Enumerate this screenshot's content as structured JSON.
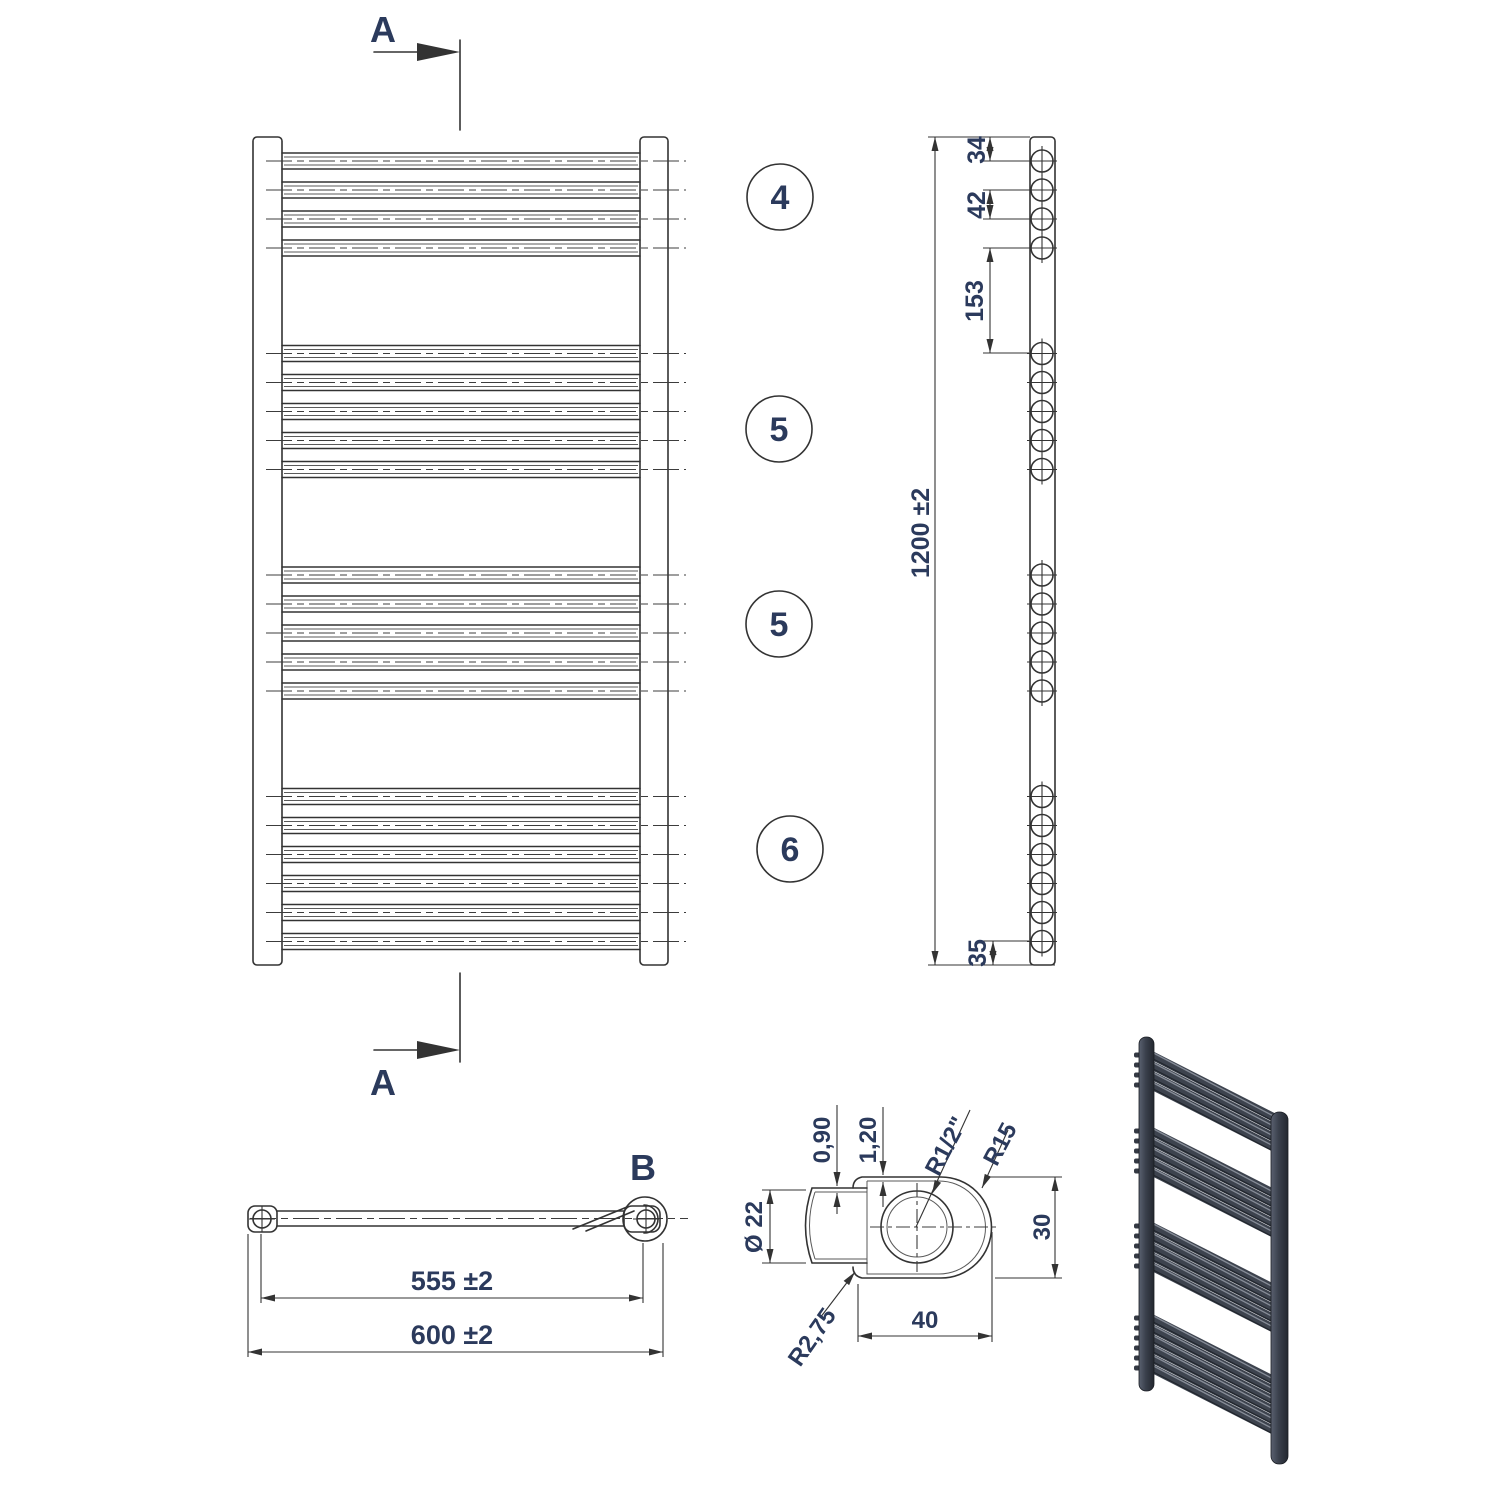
{
  "views": {
    "front": {
      "section_label_top": "A",
      "section_label_bottom": "A"
    },
    "side": {
      "dim_top_offset": "34",
      "dim_bar_pitch": "42",
      "dim_group_gap": "153",
      "dim_height": "1200 ±2",
      "dim_bottom_offset": "35"
    },
    "plan": {
      "detail_label": "B",
      "dim_inner": "555 ±2",
      "dim_outer": "600 ±2"
    },
    "detail": {
      "dim_tube_wall": "0,90",
      "dim_collector_wall": "1,20",
      "dim_thread": "R1/2\"",
      "dim_end_radius": "R15",
      "dim_tube_dia": "Ø 22",
      "dim_height": "30",
      "dim_width": "40",
      "dim_corner_radius": "R2,75"
    }
  },
  "radiator": {
    "bar_groups": [
      4,
      5,
      5,
      6
    ],
    "group_labels": [
      "4",
      "5",
      "5",
      "6"
    ]
  },
  "colors": {
    "line": "#333333",
    "text": "#2b3a5c",
    "render_body": "#3d434e",
    "render_dark": "#1d2128",
    "render_light": "#8d939e"
  }
}
